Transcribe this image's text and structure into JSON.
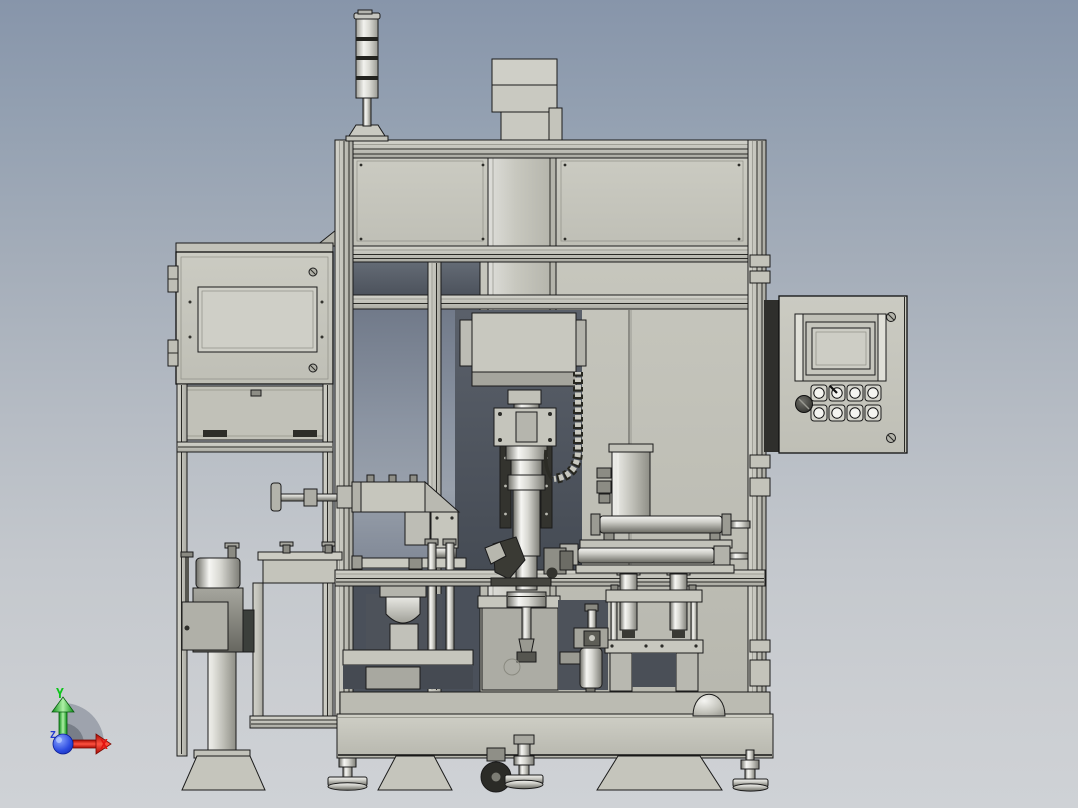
{
  "scene": {
    "type": "cad-3d-viewport",
    "description": "Front view of an automated press / assembly machine 3D CAD model",
    "background": {
      "top": "#8795aa",
      "bottom": "#cfd2d6"
    },
    "palette": {
      "machine_body": "#c7c7be",
      "outline": "#1b1b1b",
      "dark_back_panel": "#555b64",
      "metal_highlight": "#f6f6f3",
      "metal_shadow": "#6f6f68"
    },
    "components": [
      "signal-tower-light",
      "top-motor-block",
      "main-frame",
      "top-sheet-panels",
      "left-hmi-enclosure",
      "right-control-panel",
      "press-head",
      "press-spindle",
      "cable-drag-chain",
      "guide-bars",
      "rotary-feeder-drum",
      "pedestal-stand",
      "handwheel-slide",
      "bracket-cluster",
      "hopper-chute",
      "pneumatic-cylinders",
      "vertical-cylinder-unit",
      "die-set-fixture",
      "air-filter-regulator",
      "dome-cover",
      "base-slab",
      "trapezoid-feet",
      "leveling-feet",
      "caster-wheel"
    ]
  },
  "tower_light": {
    "segments": 4
  },
  "control_panel": {
    "has_screen": true,
    "button_rows": 2,
    "buttons_per_row": 4,
    "has_selector_knob": true,
    "corner_screws": 2
  },
  "axis_triad": {
    "x_label": "X",
    "y_label": "Y",
    "z_label": "Z",
    "x_color": "#e41410",
    "y_color": "#0cc41a",
    "z_color": "#2038d0"
  }
}
